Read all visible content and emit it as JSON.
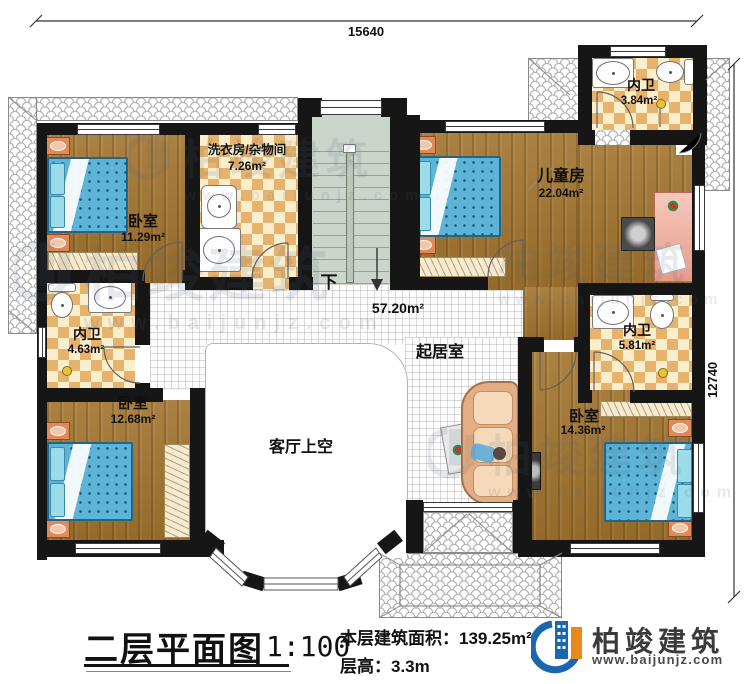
{
  "plan": {
    "dimensions": {
      "top": "15640",
      "right": "12740"
    },
    "stairs_label": "下",
    "rooms": [
      {
        "name": "卧室",
        "area": "11.29m²"
      },
      {
        "name": "洗衣房/杂物间",
        "area": "7.26m²"
      },
      {
        "name": "儿童房",
        "area": "22.04m²"
      },
      {
        "name": "内卫",
        "area": "3.84m²"
      },
      {
        "name": "内卫",
        "area": "4.63m²"
      },
      {
        "name": "内卫",
        "area": "5.81m²"
      },
      {
        "name": "卧室",
        "area": "12.68m²"
      },
      {
        "name": "卧室",
        "area": "14.36m²"
      },
      {
        "name": "起居室",
        "area": "57.20m²"
      },
      {
        "name": "客厅上空",
        "area": ""
      }
    ]
  },
  "title_block": {
    "plan_title": "二层平面图",
    "scale": "1:100",
    "area_label": "本层建筑面积：",
    "area_value": "139.25m²",
    "height_label": "层高：",
    "height_value": "3.3m"
  },
  "brand": {
    "name": "柏竣建筑",
    "website": "www.baijunjz.com"
  },
  "watermark": {
    "name": "柏竣建筑",
    "website": "www.baijunjz.com"
  },
  "colors": {
    "wall": "#161616",
    "wood": "#a1732d",
    "tile_checker": "#e7b26c",
    "bed": "#5db4d7",
    "logo_blue": "#1b66ad",
    "logo_orange": "#e8891d"
  }
}
